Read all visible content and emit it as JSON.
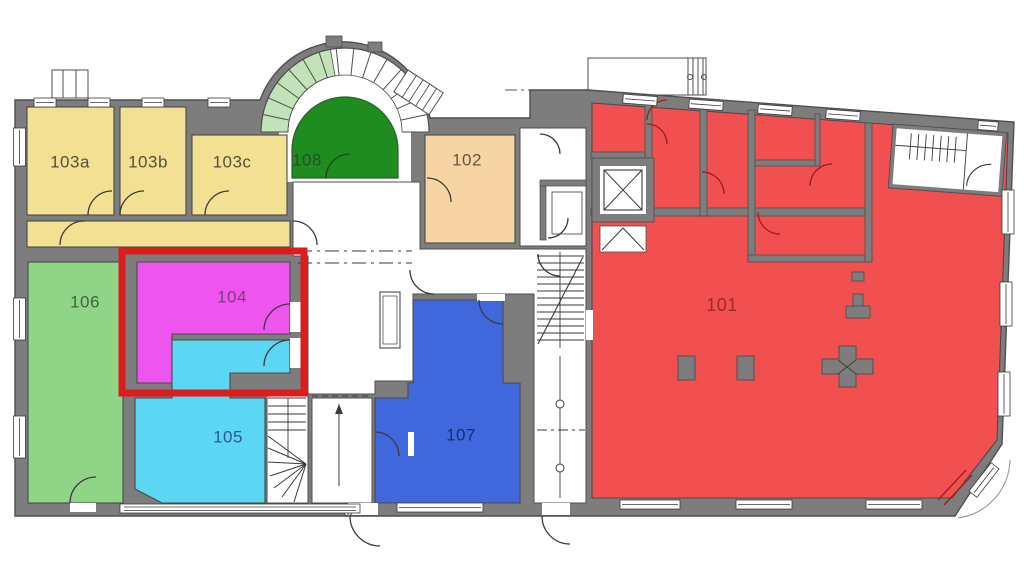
{
  "rooms": [
    {
      "id": "101",
      "label": "101",
      "color": "#f25050",
      "label_color": "#9e2a28"
    },
    {
      "id": "102",
      "label": "102",
      "color": "#f6d4a4",
      "label_color": "#6a523f"
    },
    {
      "id": "103a",
      "label": "103a",
      "color": "#f3e092",
      "label_color": "#55513a"
    },
    {
      "id": "103b",
      "label": "103b",
      "color": "#f3e092",
      "label_color": "#55513a"
    },
    {
      "id": "103c",
      "label": "103c",
      "color": "#f3e092",
      "label_color": "#55513a"
    },
    {
      "id": "104",
      "label": "104",
      "color": "#ee55ee",
      "label_color": "#7a3e7a",
      "highlighted": true
    },
    {
      "id": "105",
      "label": "105",
      "color": "#5cd6f2",
      "label_color": "#2a5a92"
    },
    {
      "id": "106",
      "label": "106",
      "color": "#90d587",
      "label_color": "#45603f"
    },
    {
      "id": "107",
      "label": "107",
      "color": "#4068dc",
      "label_color": "#192c7a"
    },
    {
      "id": "108",
      "label": "108",
      "color": "#1f8c1f",
      "label_color": "#2c4c2c"
    }
  ],
  "highlight": {
    "room_id": "104",
    "color": "#db1d1d"
  },
  "palette": {
    "wall": "#7d7d7d",
    "wall_edge": "#4f4f4f",
    "background": "#ffffff",
    "line": "#3a3a3a",
    "stair_tint": "#c2e2b8",
    "door_red": "#9b1e1e"
  }
}
